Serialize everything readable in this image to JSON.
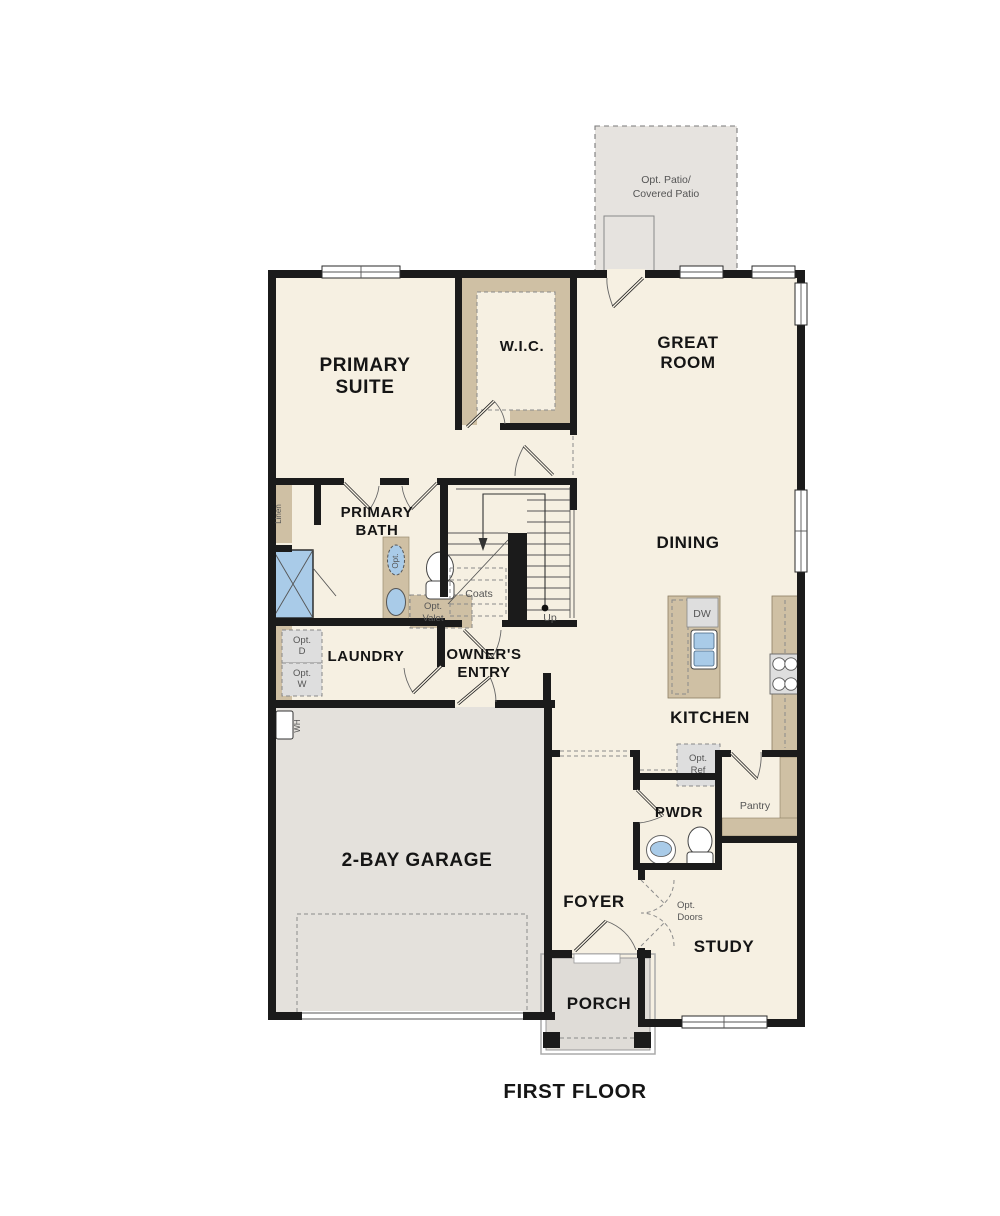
{
  "title": "FIRST FLOOR",
  "colors": {
    "floor_cream": "#f6f0e2",
    "garage_gray": "#e4e1dc",
    "patio_gray": "#e6e3df",
    "porch_gray": "#dfdcd7",
    "cabinet_tan": "#cfc0a4",
    "fixture_blue": "#a9cbe8",
    "wall_black": "#1b1b1b",
    "appliance_gray": "#dedede"
  },
  "rooms": {
    "patio": {
      "line1": "Opt. Patio/",
      "line2": "Covered Patio"
    },
    "primary_suite": {
      "line1": "PRIMARY",
      "line2": "SUITE"
    },
    "wic": {
      "label": "W.I.C."
    },
    "great_room": {
      "line1": "GREAT",
      "line2": "ROOM"
    },
    "primary_bath": {
      "line1": "PRIMARY",
      "line2": "BATH"
    },
    "dining": {
      "label": "DINING"
    },
    "laundry": {
      "label": "LAUNDRY"
    },
    "owners_entry": {
      "line1": "OWNER'S",
      "line2": "ENTRY"
    },
    "kitchen": {
      "label": "KITCHEN"
    },
    "garage": {
      "label": "2-BAY GARAGE"
    },
    "pwdr": {
      "label": "PWDR"
    },
    "pantry": {
      "label": "Pantry"
    },
    "foyer": {
      "label": "FOYER"
    },
    "study": {
      "label": "STUDY"
    },
    "porch": {
      "label": "PORCH"
    }
  },
  "annotations": {
    "linen": "Linen",
    "coats": "Coats",
    "up": "Up",
    "wh": "WH",
    "dw": "DW",
    "opt_sink": "Opt.",
    "opt_valet": {
      "line1": "Opt.",
      "line2": "Valet"
    },
    "opt_dryer": {
      "line1": "Opt.",
      "line2": "D"
    },
    "opt_washer": {
      "line1": "Opt.",
      "line2": "W"
    },
    "opt_ref": {
      "line1": "Opt.",
      "line2": "Ref"
    },
    "opt_doors": {
      "line1": "Opt.",
      "line2": "Doors"
    }
  }
}
